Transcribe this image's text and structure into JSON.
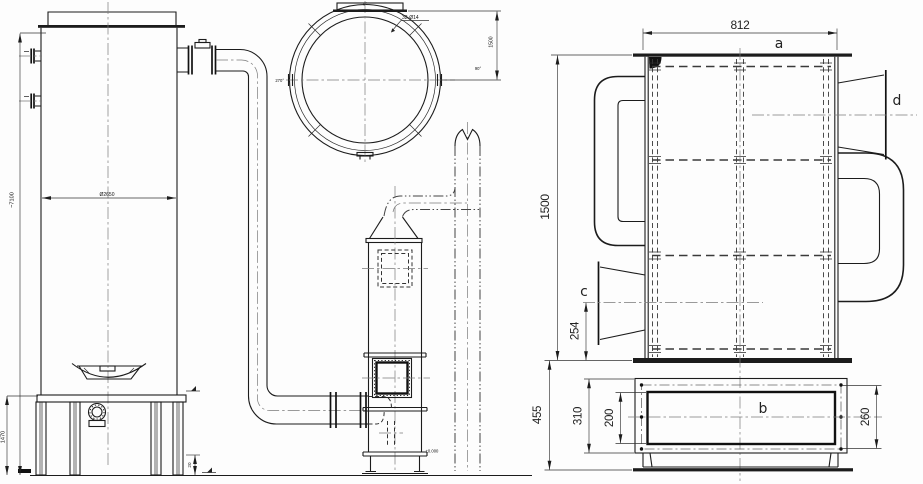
{
  "colors": {
    "ink": "#1c1c1c",
    "background": "#fdfdfd"
  },
  "left_view": {
    "overall_height": "~7100",
    "tank_diameter": "Ø2650",
    "support_height": "1470",
    "base_clearance": "20",
    "level_mark": "±0.000"
  },
  "top_view": {
    "bolt_callout": "32-Ø14",
    "radius": "1500",
    "angle_top": "0°",
    "angle_right": "90°",
    "angle_left": "270°"
  },
  "right_view": {
    "width": "812",
    "body_height": "1500",
    "base_height": "455",
    "nozzle_offset": "254",
    "flange_height": "310",
    "opening_height": "200",
    "bolt_height": "260",
    "label_a": "a",
    "label_b": "b",
    "label_c": "c",
    "label_d": "d"
  }
}
